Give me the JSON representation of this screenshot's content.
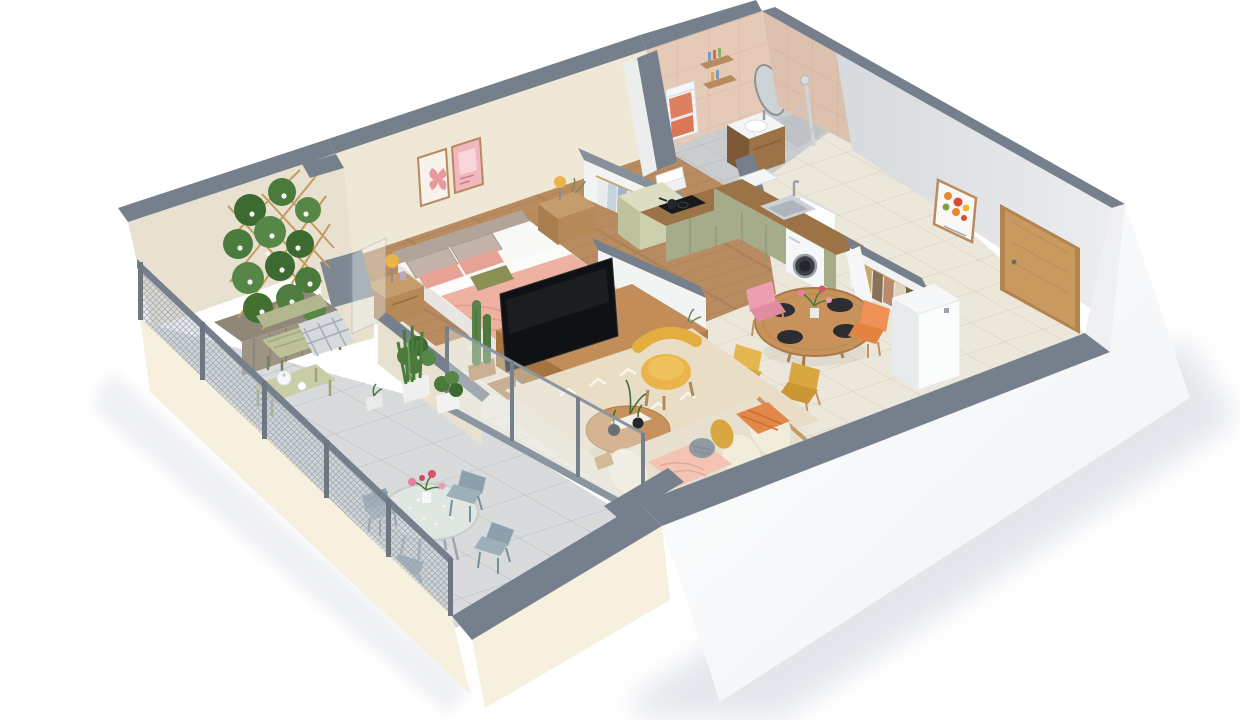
{
  "meta": {
    "kind": "3d-isometric-floor-plan-render",
    "style": "cutaway apartment dollhouse view, white studio background with soft drop shadow"
  },
  "palette": {
    "background": "#ffffff",
    "shadow": "#dfe3e9",
    "wall_cap": "#76808c",
    "wall_cap_dark": "#5f6975",
    "terrace_wall": "#e9e1cf",
    "bedroom_wall": "#f0e8d6",
    "interior_white": "#f2f3f3",
    "hall_wall": "#e3e5e8",
    "exterior_white": "#fdfdfe",
    "parapet_cream": "#f7f0df",
    "bath_tile": "#e6cab8",
    "bath_tile_dark": "#dcc0ae",
    "wood_floor": "#b88c60",
    "tile_floor": "#ece7db",
    "terrace_tile": "#d8dadb",
    "bath_floor": "#c9cdce",
    "rug": "#e9ddc6",
    "bed_rug": "#e7ddc7",
    "bed_blanket": "#eeb1a2",
    "bed_sheet": "#f8f8f6",
    "headboard": "#b3a49a",
    "pillow_taupe": "#c3b2a7",
    "pillow_pink": "#e6a294",
    "pillow_olive": "#8d9055",
    "nightstand_wood": "#c59c6c",
    "kitchen_cabinet": "#a6ab8a",
    "counter_wood": "#9c7347",
    "washer_white": "#f6f7f8",
    "hob_black": "#17191d",
    "sofa_cream": "#f2ecda",
    "sofa_pink": "#f3c4b4",
    "throw_orange": "#e28848",
    "armchair_yellow": "#e9b54a",
    "chair_pink": "#ec9fb1",
    "chair_orange": "#ef9156",
    "chair_mustard": "#d8a73f",
    "chair_yellow": "#e5b74e",
    "table_wood": "#c7925c",
    "console_wood": "#c28d58",
    "plant_green": "#4c7a3d",
    "plant_dark": "#3c6a31",
    "railing": "#76808c",
    "mesh": "#9aa3ad",
    "bistro_chair": "#8ba0ac",
    "bistro_table_top": "#e0e6e2",
    "door_oak": "#c99a5f",
    "tv_black": "#0f1114",
    "trellis_tan": "#c59a62",
    "bench_sage": "#bcc196",
    "radiator_white": "#f6f7f8",
    "towel_coral": "#e08063",
    "mirror_glass": "#ccd4d6"
  },
  "scene": {
    "rooms": [
      {
        "id": "terrace",
        "furniture": [
          "mesh-railing",
          "flower-trellis-planter",
          "garden-bench-with-plaid",
          "slatted-tea-table",
          "round-bistro-table-with-flowers",
          "four-metal-chairs",
          "potted-plants"
        ]
      },
      {
        "id": "bedroom",
        "furniture": [
          "double-bed-pink-bedding",
          "two-nightstands-with-yellow-lamps",
          "two-botanical-posters",
          "area-rug",
          "tv-sideboard",
          "cacti-planter"
        ]
      },
      {
        "id": "bathroom",
        "furniture": [
          "pink-tiled-walls",
          "towel-radiator-coral-towels",
          "oval-mirror",
          "wood-vanity-basin",
          "shower-column",
          "wall-shelves"
        ]
      },
      {
        "id": "dressing",
        "furniture": [
          "open-wardrobe-hanging-clothes",
          "folded-linen",
          "sage-cabinet"
        ]
      },
      {
        "id": "kitchen",
        "furniture": [
          "l-shaped-sage-cabinets",
          "wood-countertop",
          "induction-hob",
          "corner-basin",
          "steel-sink",
          "washing-machine"
        ]
      },
      {
        "id": "dining",
        "furniture": [
          "round-wood-table",
          "four-place-settings",
          "pink-chair",
          "orange-chair",
          "mustard-chair",
          "yellow-chair",
          "centerpiece-flowers"
        ]
      },
      {
        "id": "living",
        "furniture": [
          "sofa-with-cushions",
          "yellow-armchair",
          "organic-coffee-table",
          "patterned-rug",
          "sliding-glass-doors"
        ]
      },
      {
        "id": "hallway",
        "furniture": [
          "oak-entrance-door",
          "abstract-fruit-poster",
          "open-coat-closet",
          "white-storage-cabinet",
          "interior-doors"
        ]
      }
    ]
  }
}
